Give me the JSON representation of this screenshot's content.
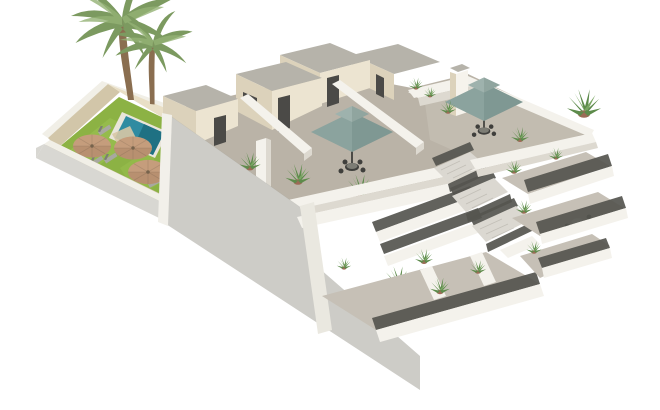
{
  "scene": {
    "kind": "3d-architectural-render",
    "subject": "two-storey apartment building with rooftop solarium terraces, stepped balconies, exterior staircase and walled pool garden",
    "background": "white",
    "objects": {
      "palm_trees": 2,
      "garden_parasols": 3,
      "sun_loungers": 6,
      "swimming_pool": 1,
      "rooftop_umbrellas": 2,
      "dining_sets": 2,
      "balcony_levels": 3,
      "staircase_flights": 3,
      "potted_plants": 16,
      "stair_tower_doors": 5,
      "louver_vents": 1
    }
  },
  "colors": {
    "bg": "#ffffff",
    "lawn": "#8cb244",
    "lawn_light": "#9dc253",
    "pool_water": "#2f8ba1",
    "pool_deep": "#1f7183",
    "pool_coping": "#e9e5da",
    "sand": "#d8c7a5",
    "parasol": "#c59d7c",
    "parasol_shade": "#a87f5f",
    "parasol_hub": "#77634c",
    "lounger": "#a8a8a0",
    "lounger_dark": "#7d7d75",
    "trunk": "#8a6e50",
    "palm": "#7c9a60",
    "palm_light": "#94b274",
    "trav_lit": "#e9dfc6",
    "trav_shadow": "#d2c6a9",
    "wall_cap": "#f1efe7",
    "gray_wall_outer": "#d8d7d2",
    "big_wall": "#cdccc7",
    "corner_lit": "#f2f0ea",
    "cream_lit": "#ece4d1",
    "cream_shadow": "#dcd2bb",
    "cream_bright": "#f6f3ec",
    "roof": "#b6b3aa",
    "door": "#4b4a47",
    "deck": "#bab3a7",
    "deck_right": "#c3bcb1",
    "parapet_white": "#f4f2ec",
    "parapet_shadow": "#ddd9d0",
    "step_edge": "#eae8e0",
    "umbrella": "#8ba39e",
    "umbrella_dark": "#6f8782",
    "umbrella_vent": "#9eb2ad",
    "furniture": "#3f3f3c",
    "table_light": "#eeeae0",
    "railing": "#55554f",
    "step_light": "#dbd8d1",
    "floor_low": "#c6c0b6",
    "pot": "#9c6b56",
    "plant": "#5d8b4b",
    "plant_light": "#7aa763",
    "banana": "#679757"
  }
}
